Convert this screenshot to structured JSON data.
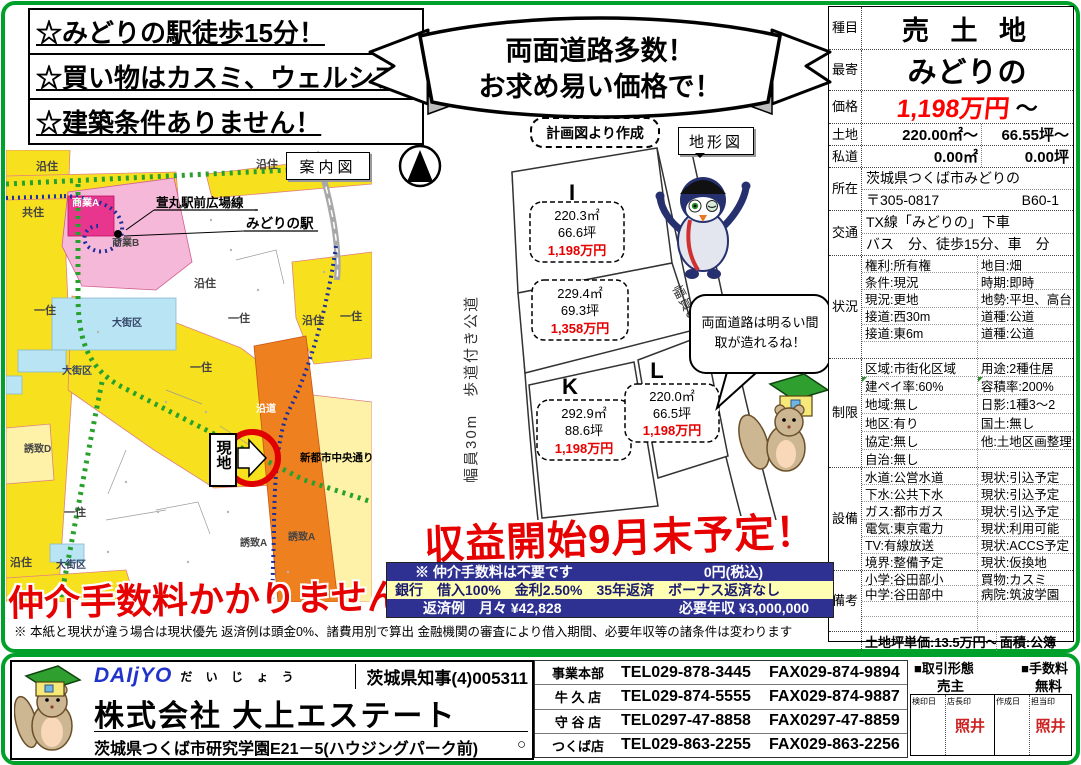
{
  "page": {
    "frame_color": "#00a12b",
    "accent_red": "#e60000",
    "navy": "#2e3192",
    "loan_yellow": "#ffffb3"
  },
  "highlights": [
    "☆みどりの駅徒歩15分！",
    "☆買い物はカスミ、ウェルシア！",
    "☆建築条件ありません！"
  ],
  "banner": {
    "line1": "両面道路多数！",
    "line2": "お求め易い価格で！"
  },
  "plan_note": "計画図より作成",
  "terrain_label": "地形図",
  "sale_notice": "収益開始9月末予定！",
  "commission_notice": "仲介手数料かかりません！",
  "disclaimer": "※ 本紙と現状が違う場合は現状優先 返済例は頭金0%、諸費用別で算出 金融機関の審査により借入期間、必要年収等の諸条件は変わります",
  "loan": {
    "row1_left": "※ 仲介手数料は不要です",
    "row1_right": "0円(税込)",
    "row2": "銀行　借入100%　金利2.50%　35年返済　ボーナス返済なし",
    "row3_left": "返済例　月々 ¥42,828",
    "row3_right": "必要年収 ¥3,000,000"
  },
  "plot": {
    "road_30m": "幅員30m　歩道付き公道",
    "road_6m": "幅員6m 公道",
    "bubble1": "両面道路は明るい間",
    "bubble2": "取が造れるね！",
    "lots": [
      {
        "id": "I",
        "area": "220.3㎡",
        "tsubo": "66.6坪",
        "price": "1,198万円"
      },
      {
        "id": "J",
        "area": "229.4㎡",
        "tsubo": "69.3坪",
        "price": "1,358万円"
      },
      {
        "id": "K",
        "area": "292.9㎡",
        "tsubo": "88.6坪",
        "price": "1,198万円"
      },
      {
        "id": "L",
        "area": "220.0㎡",
        "tsubo": "66.5坪",
        "price": "1,198万円"
      }
    ]
  },
  "map": {
    "title": "案内図",
    "station_road": "萱丸駅前広場線",
    "station": "みどりの駅",
    "site": "現地",
    "main_road": "新都市中央通り",
    "zones": {
      "enju_tl": "沿住",
      "enju_tr": "沿住",
      "kyoju": "共住",
      "shogyo_a": "商業A",
      "shogyo_b": "商業B",
      "daigaiku_1": "大街区",
      "enju_mid": "沿住",
      "ichiju_1": "一住",
      "ichiju_2": "一住",
      "enju_r": "沿住",
      "ichiju_3": "一住",
      "daigaiku_2": "大街区",
      "ichiju_4": "一住",
      "yuchi_d": "誘致D",
      "endo": "沿道",
      "ichiju_5": "一住",
      "enju_bl": "沿住",
      "daigaiku_3": "大街区",
      "yuchi_a1": "誘致A",
      "yuchi_a2": "誘致A"
    }
  },
  "spec": {
    "label_shumoku": "種目",
    "shumoku": "売 土 地",
    "label_moyori": "最寄",
    "moyori": "みどりの",
    "label_kakaku": "価格",
    "kakaku": "1,198万円",
    "kakaku_tilde": "～",
    "price_color": "#ff0000",
    "label_tochi": "土地",
    "tochi_m2": "220.00㎡～",
    "tochi_tsubo": "66.55坪～",
    "label_shido": "私道",
    "shido_m2": "0.00㎡",
    "shido_tsubo": "0.00坪",
    "label_shozai": "所在",
    "shozai": "茨城県つくば市みどりの",
    "shozai_zip": "〒305-0817",
    "shozai_code": "B60-1",
    "label_kotsu": "交通",
    "kotsu1": "TX線「みどりの」下車",
    "kotsu2": "バス　分、徒歩15分、車　分",
    "label_jokyo": "状況",
    "jokyo": [
      [
        "権利:所有権",
        "地目:畑"
      ],
      [
        "条件:現況",
        "時期:即時"
      ],
      [
        "現況:更地",
        "地勢:平坦、高台"
      ],
      [
        "接道:西30m",
        "道種:公道"
      ],
      [
        "接道:東6m",
        "道種:公道"
      ],
      [
        "",
        ""
      ]
    ],
    "label_seigen": "制限",
    "seigen": [
      [
        "区域:市街化区域",
        "用途:2種住居"
      ],
      [
        "建ペイ率:60%",
        "容積率:200%"
      ],
      [
        "地域:無し",
        "日影:1種3～2"
      ],
      [
        "地区:有り",
        "国土:無し"
      ],
      [
        "協定:無し",
        "他:土地区画整理法"
      ],
      [
        "自治:無し",
        ""
      ]
    ],
    "label_setsubi": "設備",
    "setsubi": [
      [
        "水道:公営水道",
        "現状:引込予定"
      ],
      [
        "下水:公共下水",
        "現状:引込予定"
      ],
      [
        "ガス:都市ガス",
        "現状:引込予定"
      ],
      [
        "電気:東京電力",
        "現状:利用可能"
      ],
      [
        "TV:有線放送",
        "現状:ACCS予定"
      ],
      [
        "境界:整備予定",
        "現状:仮換地"
      ]
    ],
    "label_biko": "備考",
    "biko": [
      [
        "小学:谷田部小",
        "買物:カスミ"
      ],
      [
        "中学:谷田部中",
        "病院:筑波学園"
      ],
      [
        "",
        ""
      ],
      [
        "",
        ""
      ]
    ],
    "unit_price": "土地坪単価:13.5万円～",
    "area_basis": "面積:公簿"
  },
  "company": {
    "logo": "DAIjYO",
    "logo_kana": "だ い じ ょ う",
    "license": "茨城県知事(4)005311",
    "name": "株式会社 大上エステート",
    "address": "茨城県つくば市研究学園E21－5(ハウジングパーク前)",
    "offices": [
      {
        "name": "事業本部",
        "tel": "TEL029-878-3445",
        "fax": "FAX029-874-9894"
      },
      {
        "name": "牛 久 店",
        "tel": "TEL029-874-5555",
        "fax": "FAX029-874-9887"
      },
      {
        "name": "守 谷 店",
        "tel": "TEL0297-47-8858",
        "fax": "FAX0297-47-8859"
      },
      {
        "name": "つくば店",
        "tel": "TEL029-863-2255",
        "fax": "FAX029-863-2256"
      }
    ],
    "tsukuba_mark": "○"
  },
  "deal": {
    "type_label": "■取引形態",
    "type_value": "売主",
    "fee_label": "■手数料",
    "fee_value": "無料",
    "stamp_headers": [
      "検印日",
      "店長印",
      "作成日",
      "担当印"
    ],
    "stamp_manager": "照井",
    "stamp_staff": "照井",
    "stamp_color": "#cc2222"
  }
}
